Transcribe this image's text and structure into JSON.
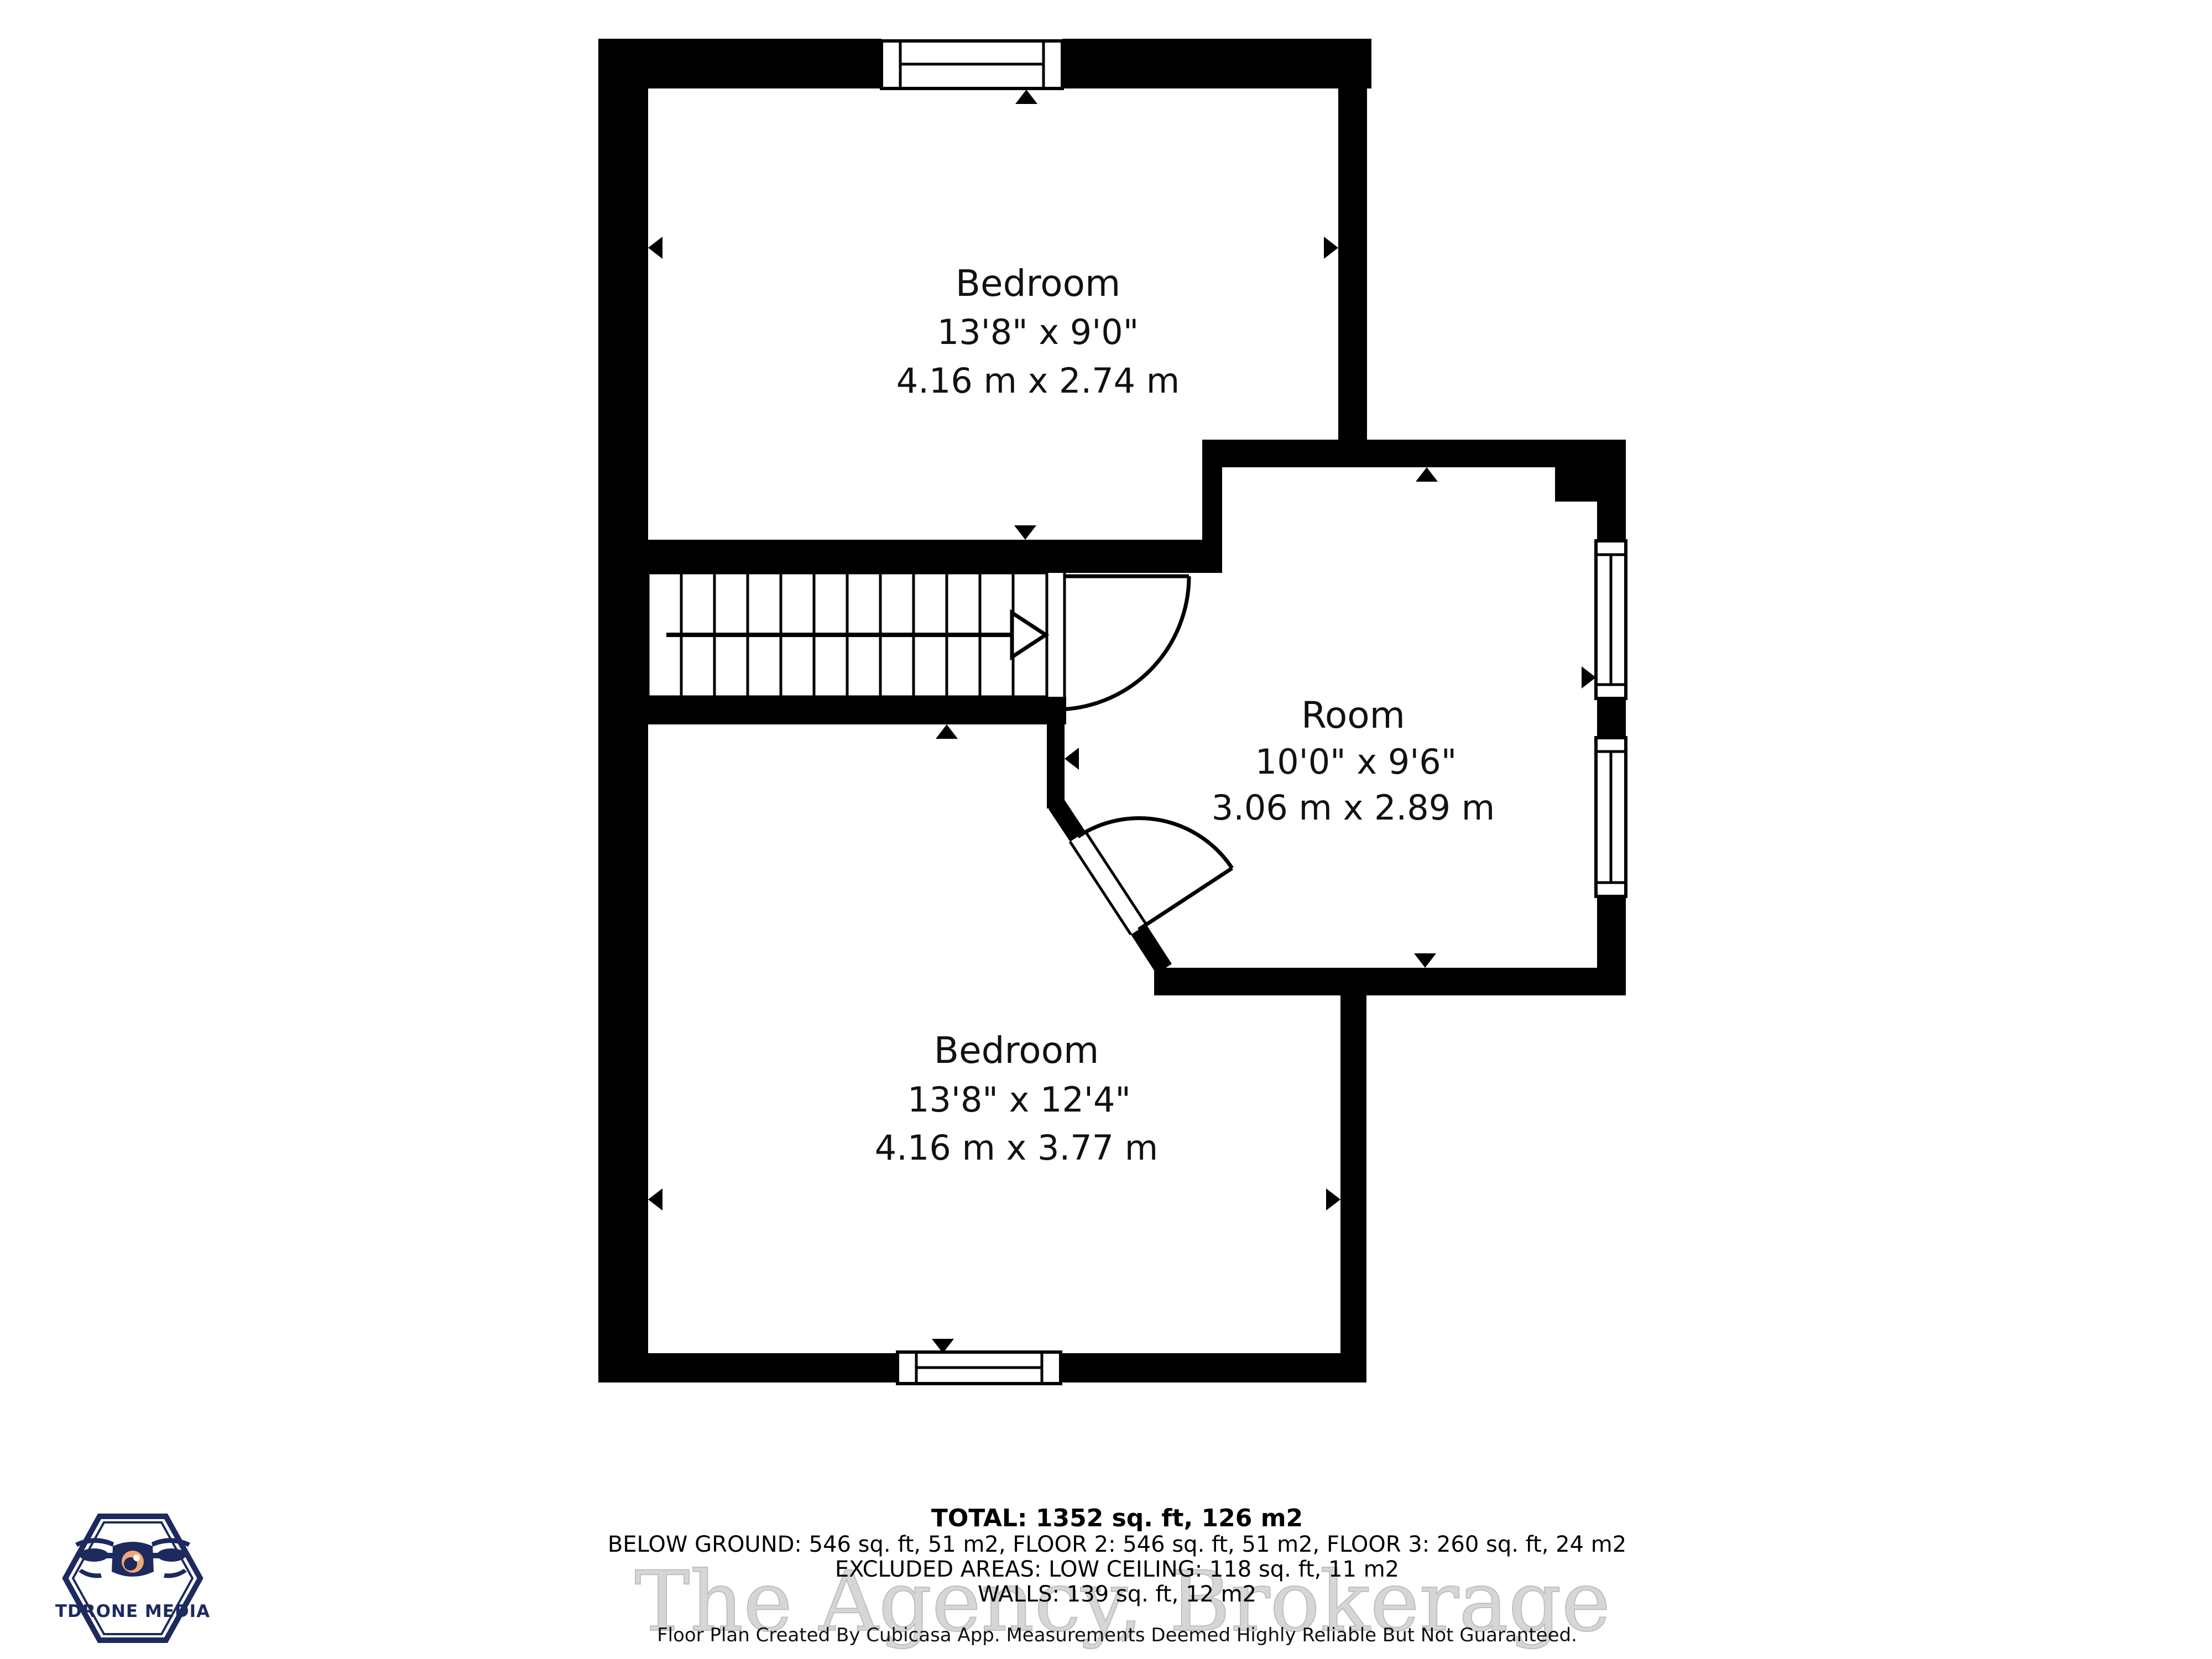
{
  "floorplan": {
    "rooms": [
      {
        "name": "Bedroom",
        "imperial": "13'8\" x 9'0\"",
        "metric": "4.16 m x 2.74 m"
      },
      {
        "name": "Room",
        "imperial": "10'0\" x 9'6\"",
        "metric": "3.06 m x 2.89 m"
      },
      {
        "name": "Bedroom",
        "imperial": "13'8\" x 12'4\"",
        "metric": "4.16 m x 3.77 m"
      }
    ]
  },
  "summary": {
    "total": "TOTAL: 1352 sq. ft, 126 m2",
    "floors": "BELOW GROUND: 546 sq. ft, 51 m2, FLOOR 2: 546 sq. ft, 51 m2, FLOOR 3: 260 sq. ft, 24 m2",
    "excluded": "EXCLUDED AREAS: LOW CEILING: 118 sq. ft, 11 m2",
    "walls": "WALLS: 139 sq. ft, 12 m2",
    "disclaimer": "Floor Plan Created By Cubicasa App. Measurements Deemed Highly Reliable But Not Guaranteed."
  },
  "watermark": "The Agency, Brokerage",
  "logo": {
    "text": "TDRONE MEDIA",
    "brand_color": "#1c2a5e",
    "lens_color": "#f0a874"
  },
  "colors": {
    "wall": "#000000",
    "background": "#ffffff",
    "watermark_gray": "#d2d2d2"
  }
}
